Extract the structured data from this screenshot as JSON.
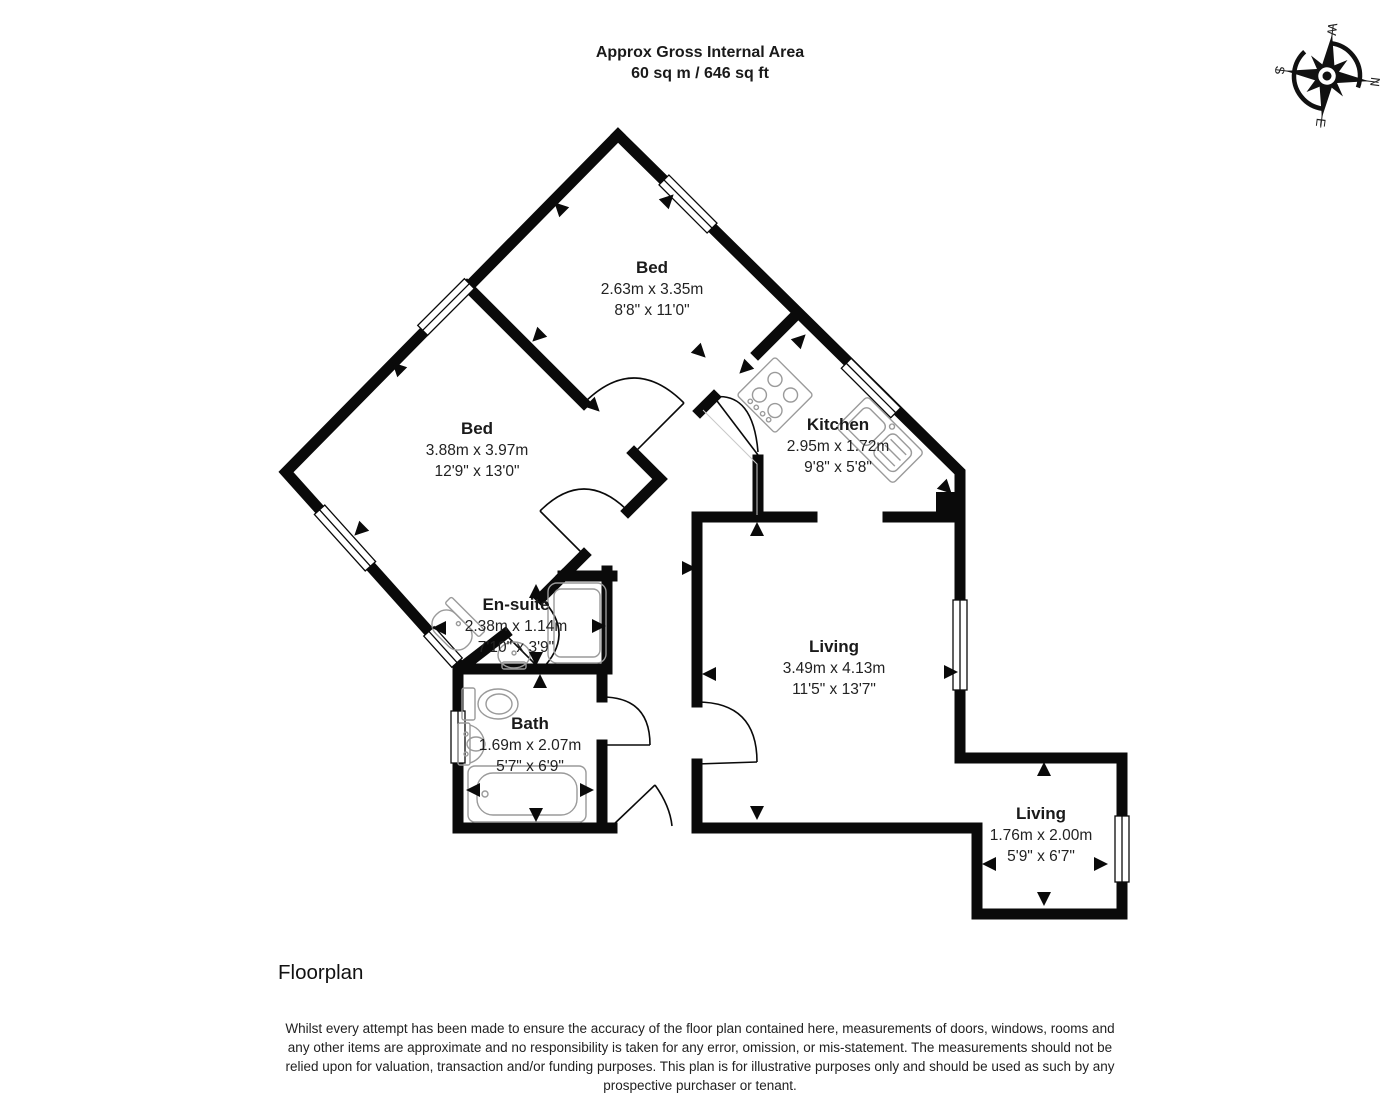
{
  "header": {
    "title_line1": "Approx Gross Internal Area",
    "title_line2": "60 sq m / 646 sq ft"
  },
  "compass": {
    "n": "N",
    "e": "E",
    "s": "S",
    "w": "W"
  },
  "rooms": [
    {
      "name": "Bed",
      "metric": "2.63m x 3.35m",
      "imperial": "8'8\" x 11'0\""
    },
    {
      "name": "Bed",
      "metric": "3.88m x 3.97m",
      "imperial": "12'9\" x 13'0\""
    },
    {
      "name": "Kitchen",
      "metric": "2.95m x 1.72m",
      "imperial": "9'8\" x 5'8\""
    },
    {
      "name": "En-suite",
      "metric": "2.38m x 1.14m",
      "imperial": "7'10\" x 3'9\""
    },
    {
      "name": "Bath",
      "metric": "1.69m x 2.07m",
      "imperial": "5'7\" x 6'9\""
    },
    {
      "name": "Living",
      "metric": "3.49m x 4.13m",
      "imperial": "11'5\" x 13'7\""
    },
    {
      "name": "Living",
      "metric": "1.76m x 2.00m",
      "imperial": "5'9\" x 6'7\""
    }
  ],
  "footer": {
    "caption": "Floorplan",
    "disclaimer_lines": [
      "Whilst every attempt has been made to ensure the accuracy of the floor plan contained here, measurements of doors, windows, rooms and",
      "any other items are approximate and no responsibility is taken for any error, omission, or mis-statement. The measurements should not be",
      "relied upon for valuation, transaction and/or funding purposes. This plan is for illustrative purposes only and should be used as such by any",
      "prospective purchaser or tenant."
    ]
  },
  "colors": {
    "wall": "#0a0a0a",
    "fixture": "#9a9a9a",
    "text": "#1a1a1a"
  }
}
